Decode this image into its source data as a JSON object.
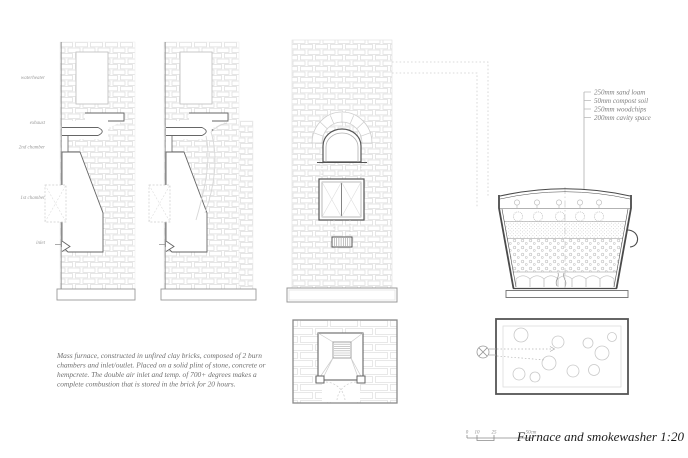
{
  "sheet": {
    "title": "Furnace and smokewasher 1:20"
  },
  "furnace_labels": [
    "waterheater",
    "exhaust",
    "2nd chamber",
    "1st chamber",
    "inlet"
  ],
  "legend": {
    "items": [
      "250mm sand loam",
      "50mm compost soil",
      "250mm woodchips",
      "200mm cavity space"
    ]
  },
  "annotation": {
    "lines": [
      "Mass furnace, constructed in unfired clay bricks, composed of 2 burn",
      "chambers and inlet/outlet. Placed on a solid plint of stone, concrete or",
      "hempcrete. The double air inlet and temp. of 700+ degrees makes a",
      "complete combustion that is stored in the brick for 20 hours."
    ]
  },
  "scale_bar": {
    "ticks": [
      "0",
      "10",
      "25",
      "50cm"
    ]
  },
  "colors": {
    "brick_line": "#dcdcdc",
    "profile_line": "#666666",
    "wall_dark": "#4a4a4a",
    "dotted_leader": "#cfcfcf",
    "text_muted": "#9a9a9a",
    "text_dark": "#1c1c1c"
  }
}
